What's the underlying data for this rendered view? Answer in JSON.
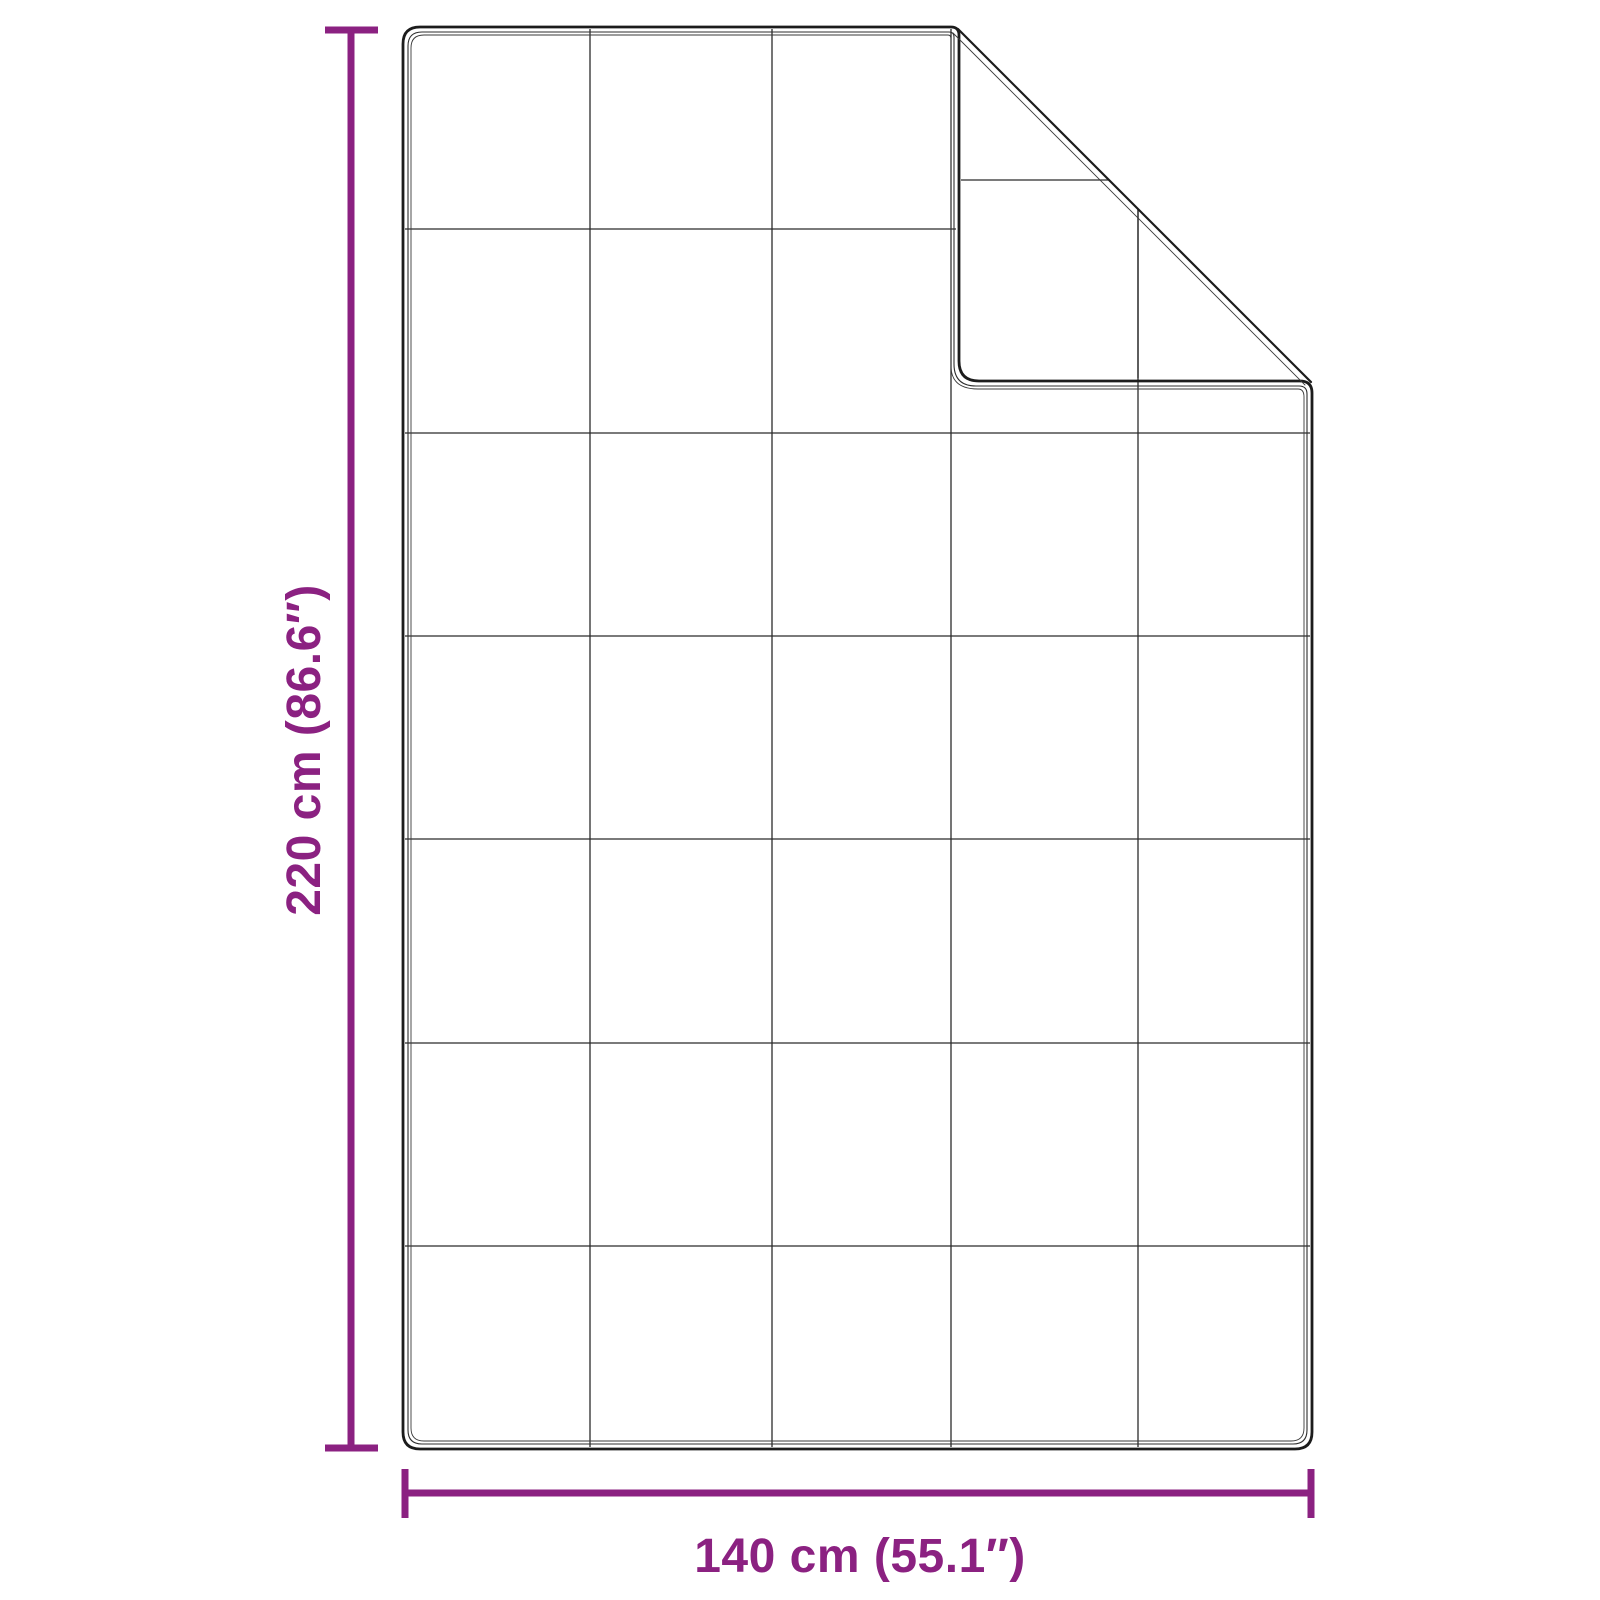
{
  "diagram": {
    "name": "blanket-dimension-diagram",
    "subject": "quilted blanket with folded top-right corner",
    "colors": {
      "accent": "#8b2181",
      "outline": "#1c1c1c",
      "outline_echo": "#3a3a3a",
      "grid": "#2b2b2b",
      "background": "#ffffff"
    },
    "height_dimension": {
      "label": "220 cm (86.6″)",
      "value_cm": 220,
      "value_in": 86.6
    },
    "width_dimension": {
      "label": "140 cm (55.1″)",
      "value_cm": 140,
      "value_in": 55.1
    },
    "quilt_grid": {
      "columns": 5,
      "rows": 7
    }
  }
}
